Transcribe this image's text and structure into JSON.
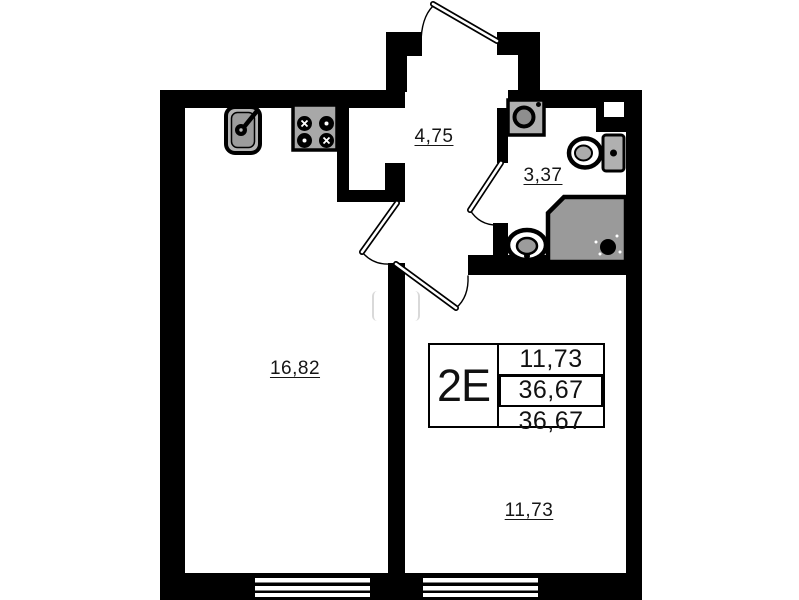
{
  "unit_card": {
    "unit": "2E",
    "values": [
      "11,73",
      "36,67",
      "36,67"
    ]
  },
  "rooms": {
    "hallway": {
      "area": "4,75"
    },
    "bathroom": {
      "area": "3,37"
    },
    "living_kitchen": {
      "area": "16,82"
    },
    "bedroom": {
      "area": "11,73"
    }
  },
  "fixtures": [
    "kitchen-sink",
    "stove",
    "washing-machine",
    "toilet",
    "shower",
    "washbasin"
  ],
  "colors": {
    "wall": "#000000",
    "fixture_gray": "#a8a8a8",
    "background": "#ffffff"
  }
}
